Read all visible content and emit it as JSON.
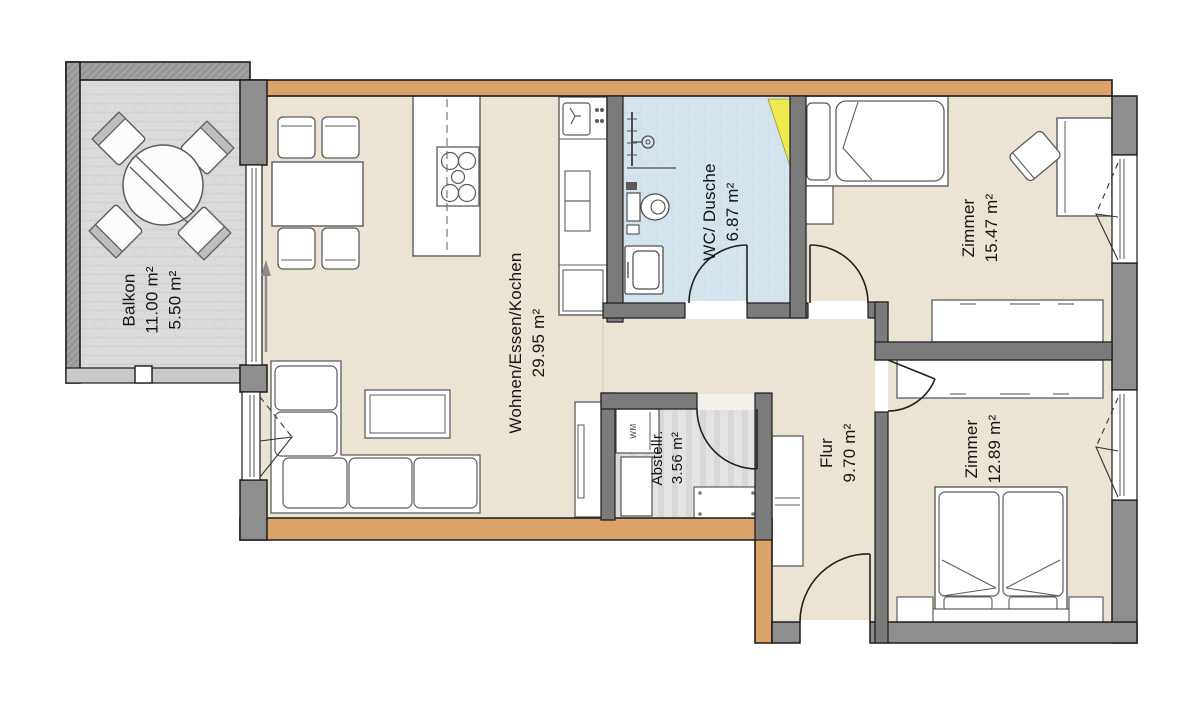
{
  "plan_title": "Wohnung Grundriss",
  "rooms": [
    {
      "name": "Balkon",
      "area": "11.00 m²",
      "area2": "5.50 m²"
    },
    {
      "name": "Wohnen/Essen/Kochen",
      "area": "29.95 m²"
    },
    {
      "name": "WC/ Dusche",
      "area": "6.87 m²"
    },
    {
      "name": "Zimmer",
      "area": "15.47 m²"
    },
    {
      "name": "Abstellr.",
      "area": "3.56 m²"
    },
    {
      "name": "Flur",
      "area": "9.70 m²"
    },
    {
      "name": "Zimmer",
      "area": "12.89 m²"
    }
  ],
  "appliances": {
    "washing_machine_label": "WM"
  },
  "colors": {
    "floor_beige": "#EBE4D4",
    "floor_wc_blue": "#D5E4EC",
    "floor_balcony": "#DBDBDB",
    "floor_storage": "#E3E3E3",
    "wall_exterior_gray": "#8E8E8E",
    "wall_interior_gray": "#7B7B7B",
    "wall_wood_orange": "#DBA369",
    "shaft_highlight_yellow": "#EDE94E"
  }
}
